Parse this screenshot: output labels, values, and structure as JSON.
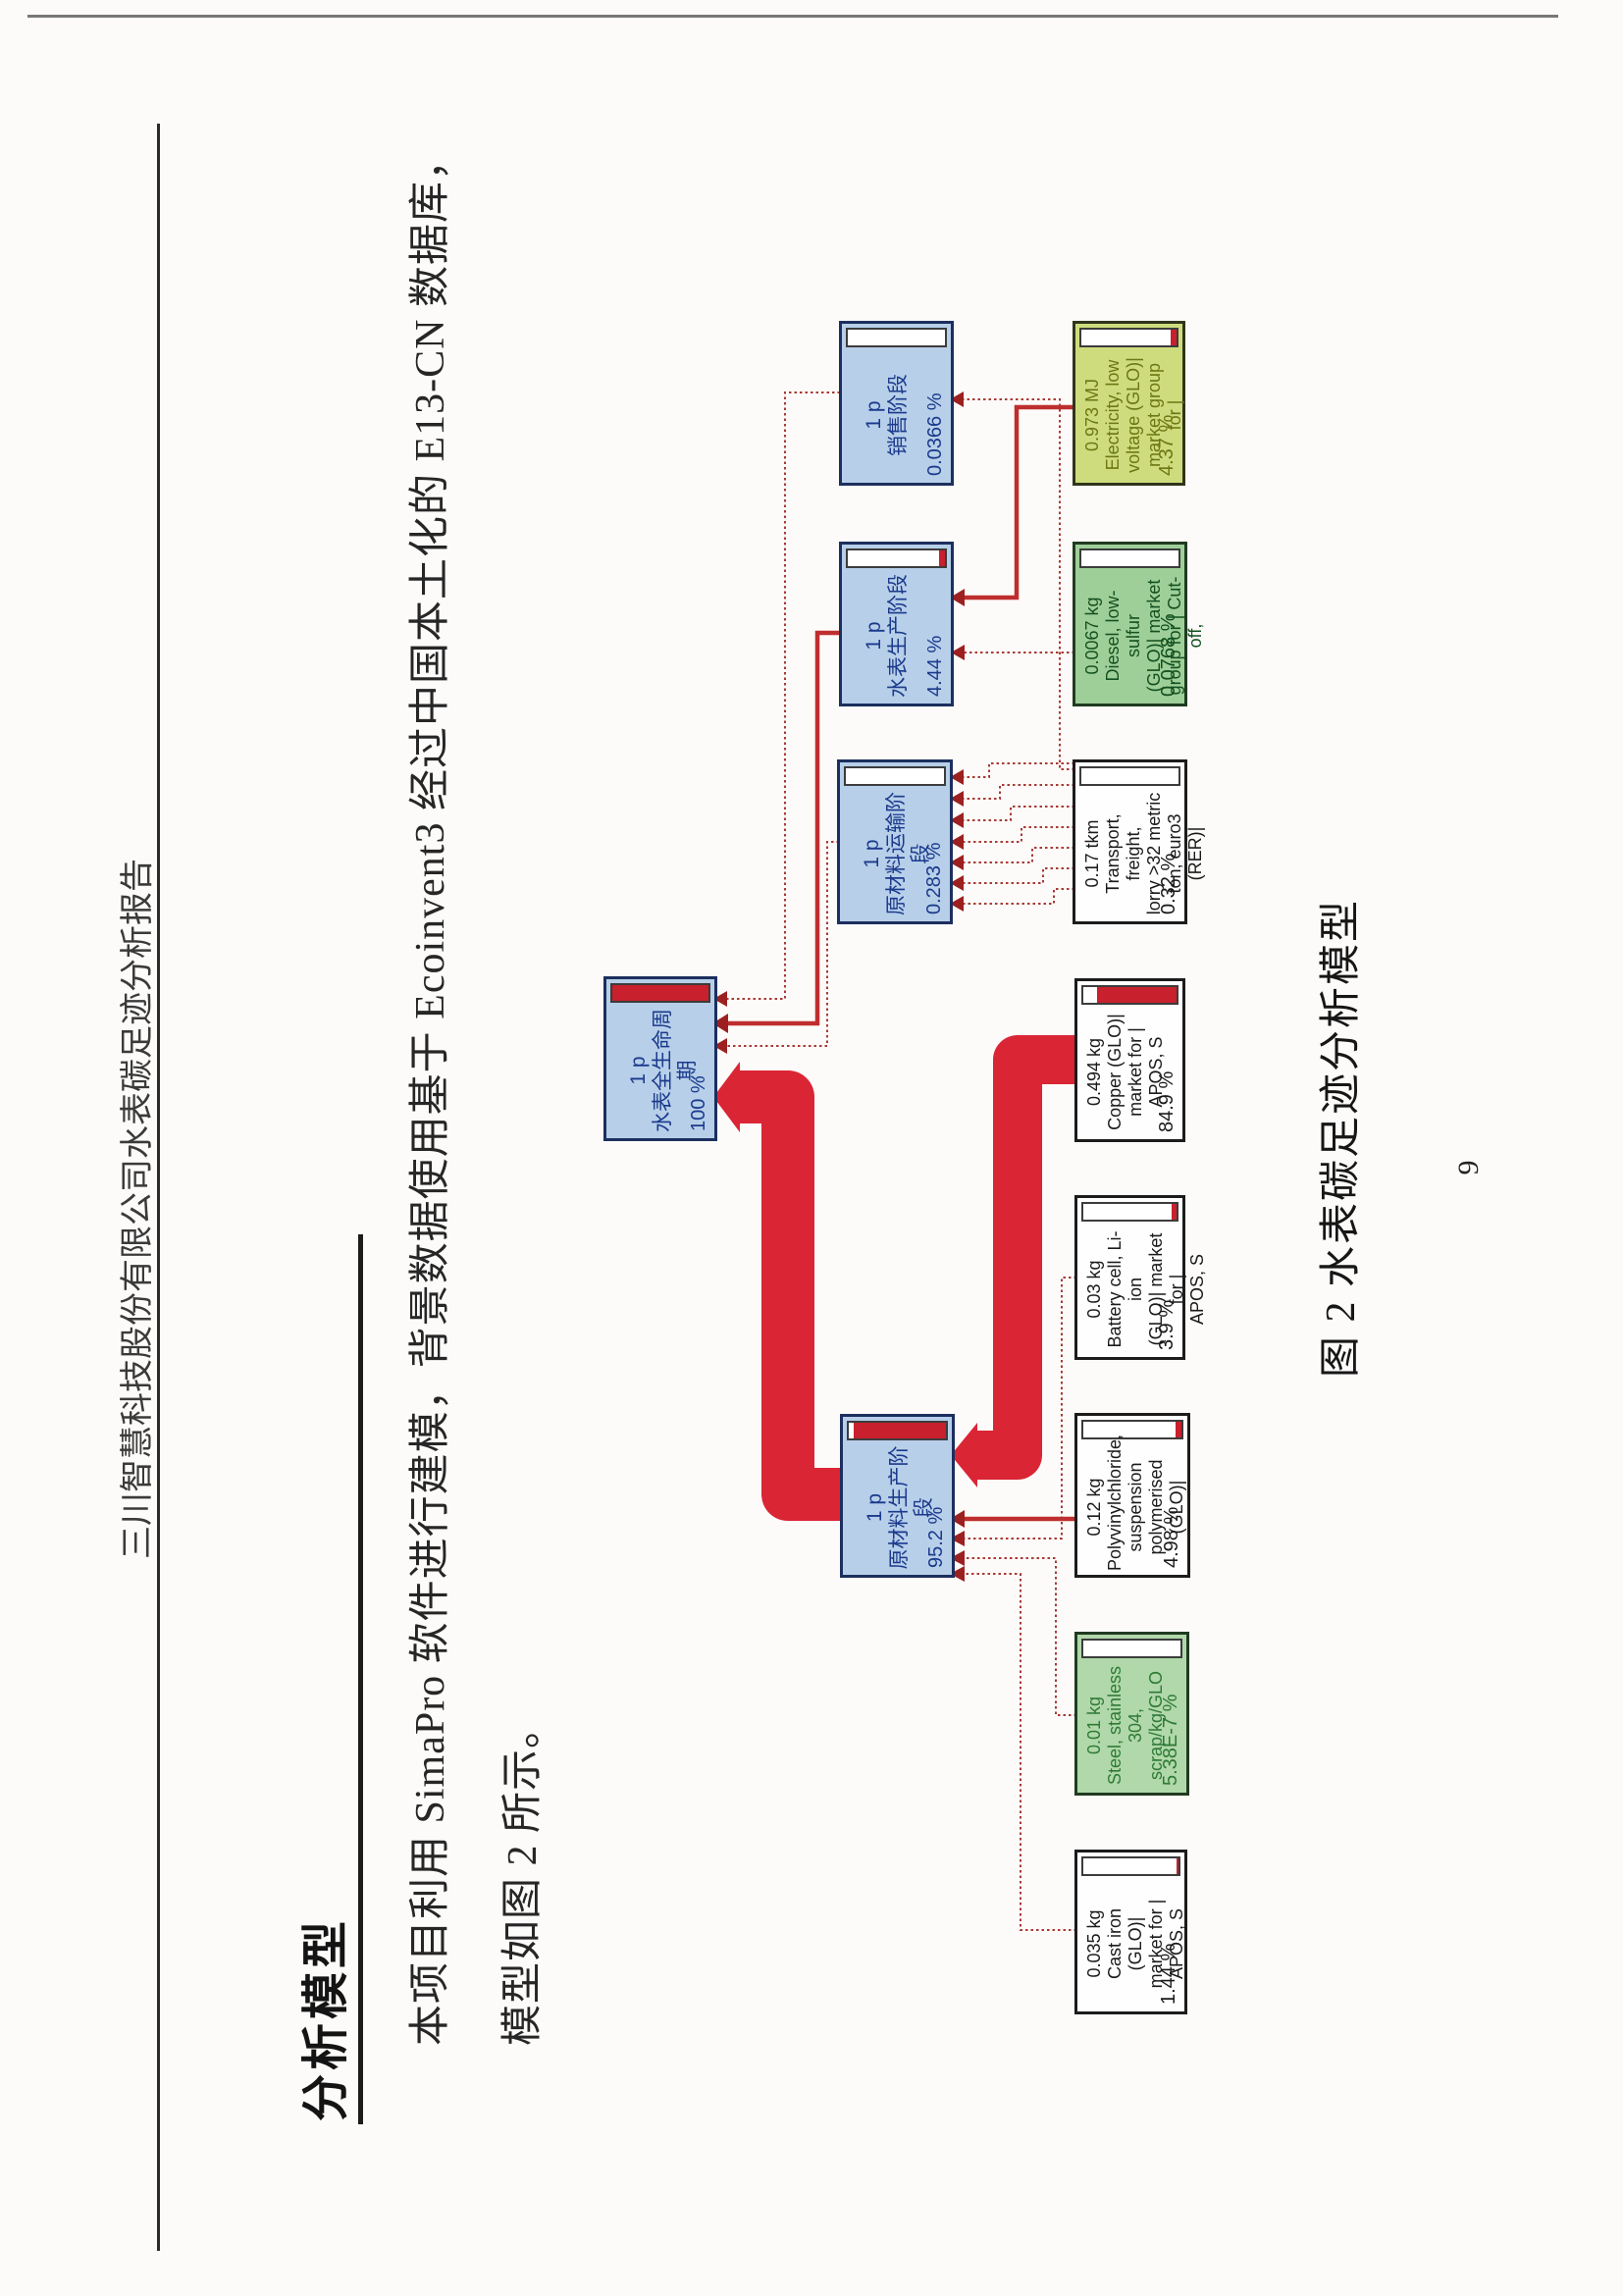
{
  "header": {
    "title": "三川智慧科技股份有限公司水表碳足迹分析报告"
  },
  "section": {
    "title": "分析模型"
  },
  "paragraph": {
    "line1": "本项目利用 SimaPro 软件进行建模，背景数据使用基于 Ecoinvent3 经过中国本土化的 E13-CN 数据库，",
    "line2": "模型如图 2 所示。"
  },
  "caption": {
    "text": "图 2  水表碳足迹分析模型"
  },
  "footer": {
    "page_number": "9"
  },
  "colors": {
    "phase_box_fill": "#b7cfe9",
    "phase_box_border": "#1c2f5e",
    "flow_red": "#da2535",
    "gauge_red": "#c8202c",
    "green_box_fill": "#9fcf98",
    "electricity_box_fill": "#cedc7d"
  },
  "diagram": {
    "boxes": [
      {
        "id": "lifecycle",
        "qty": "1 p",
        "name": "水表全生命周期",
        "pct": "100 %",
        "gauge": 100
      },
      {
        "id": "raw-material-production",
        "qty": "1 p",
        "name": "原材料生产阶段",
        "pct": "95.2 %",
        "gauge": 95
      },
      {
        "id": "raw-material-transport",
        "qty": "1 p",
        "name": "原材料运输阶段",
        "pct": "0.283 %",
        "gauge": 0
      },
      {
        "id": "meter-production",
        "qty": "1 p",
        "name": "水表生产阶段",
        "pct": "4.44 %",
        "gauge": 6
      },
      {
        "id": "sales",
        "qty": "1 p",
        "name": "销售阶段",
        "pct": "0.0366 %",
        "gauge": 0
      },
      {
        "id": "cast-iron",
        "qty": "0.035 kg",
        "name": "Cast iron (GLO)|\nmarket for | APOS, S",
        "pct": "1.44 %",
        "gauge": 2
      },
      {
        "id": "steel",
        "qty": "0.01 kg",
        "name": "Steel, stainless 304,\nscrap/kg/GLO",
        "pct": "5.38E-7 %",
        "gauge": 0
      },
      {
        "id": "pvc",
        "qty": "0.12 kg",
        "name": "Polyvinylchloride,\nsuspension\npolymerised (GLO)|",
        "pct": "4.98 %",
        "gauge": 6
      },
      {
        "id": "battery",
        "qty": "0.03 kg",
        "name": "Battery cell, Li-ion\n(GLO)| market for |\nAPOS, S",
        "pct": "3.9 %",
        "gauge": 5
      },
      {
        "id": "copper",
        "qty": "0.494 kg",
        "name": "Copper (GLO)|\nmarket for | APOS, S",
        "pct": "84.9 %",
        "gauge": 85
      },
      {
        "id": "transport",
        "qty": "0.17 tkm",
        "name": "Transport, freight,\nlorry >32 metric\nton, euro3 (RER)|",
        "pct": "0.32 %",
        "gauge": 0
      },
      {
        "id": "diesel",
        "qty": "0.0067 kg",
        "name": "Diesel, low-sulfur\n(GLO)| market\ngroup for | Cut-off,",
        "pct": "0.0768 %",
        "gauge": 0
      },
      {
        "id": "electricity",
        "qty": "0.973 MJ",
        "name": "Electricity, low\nvoltage (GLO)|\nmarket group for |",
        "pct": "4.37 %",
        "gauge": 6
      }
    ],
    "edges": [
      {
        "from": "raw-material-production",
        "to": "lifecycle",
        "share": "95.2 %",
        "weight": "thick"
      },
      {
        "from": "copper",
        "to": "raw-material-production",
        "share": "84.9 %",
        "weight": "thick"
      },
      {
        "from": "meter-production",
        "to": "lifecycle",
        "share": "4.44 %",
        "weight": "medium"
      },
      {
        "from": "raw-material-transport",
        "to": "lifecycle",
        "share": "0.283 %",
        "weight": "thin"
      },
      {
        "from": "sales",
        "to": "lifecycle",
        "share": "0.0366 %",
        "weight": "thin"
      },
      {
        "from": "electricity",
        "to": "meter-production",
        "share": "4.37 %",
        "weight": "medium"
      },
      {
        "from": "electricity",
        "to": "sales",
        "share": "",
        "weight": "thin"
      },
      {
        "from": "diesel",
        "to": "meter-production",
        "share": "0.0768 %",
        "weight": "thin"
      },
      {
        "from": "transport",
        "to": "raw-material-transport",
        "share": "0.32 %",
        "weight": "thin"
      },
      {
        "from": "pvc",
        "to": "raw-material-production",
        "share": "4.98 %",
        "weight": "medium"
      },
      {
        "from": "battery",
        "to": "raw-material-production",
        "share": "3.9 %",
        "weight": "thin"
      },
      {
        "from": "steel",
        "to": "raw-material-production",
        "share": "5.38E-7 %",
        "weight": "thin"
      },
      {
        "from": "cast-iron",
        "to": "raw-material-production",
        "share": "1.44 %",
        "weight": "thin"
      }
    ]
  }
}
